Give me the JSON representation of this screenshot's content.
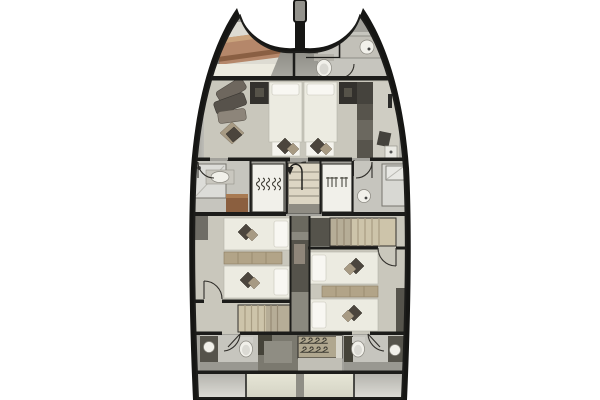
{
  "window": {
    "page-bg": "#ffffff"
  },
  "palette": {
    "hull": "#161614",
    "deck-side": "#a3a29c",
    "floor": "#c9c7bc",
    "floor-light": "#dddbd2",
    "floor-bath": "#c6c5be",
    "bed": "#ecebe1",
    "pillow-white": "#f8f7f2",
    "pillow-dark": "#4b453d",
    "pillow-tan": "#a79a83",
    "wood": "#b5876a",
    "wood-dark": "#8a5f43",
    "cabinet-dark": "#33312d",
    "cabinet-gray": "#57544c",
    "locker": "#f1f0ea",
    "stair": "#ddd6c4",
    "stair-aft": "#cdc4aa",
    "sideboard": "#b2a488",
    "fixture-white": "#f1f0ea",
    "counter-dark": "#55534b",
    "center-dark": "#8b897f",
    "wall": "#1c1c1a"
  },
  "plan": {
    "type": "catamaran-deck-plan",
    "orientation": "bow-up",
    "hulls": 2,
    "rooms": [
      {
        "name": "port-bow-cabin",
        "furniture": [
          "crew-berth"
        ]
      },
      {
        "name": "starboard-bow-head",
        "furniture": [
          "sink",
          "toilet",
          "door"
        ]
      },
      {
        "name": "owner-cabin-forward",
        "furniture": [
          "sofa",
          "armchair-cushions",
          "dresser-port",
          "berth-port",
          "berth-starboard",
          "dresser-starboard",
          "wardrobe",
          "stool",
          "foot-benches"
        ]
      },
      {
        "name": "port-mid-bathroom",
        "furniture": [
          "shower",
          "vanity-sink",
          "wood-counter",
          "door"
        ]
      },
      {
        "name": "forward-companionway",
        "furniture": [
          "staircase-with-arrow",
          "hanging-locker-port",
          "hanging-locker-starboard"
        ]
      },
      {
        "name": "starboard-mid-bathroom",
        "furniture": [
          "shower",
          "sink",
          "mirror",
          "door"
        ]
      },
      {
        "name": "port-aft-cabin",
        "furniture": [
          "twin-berth-forward",
          "sideboard",
          "twin-berth-aft",
          "door",
          "staircase"
        ]
      },
      {
        "name": "starboard-aft-cabin",
        "furniture": [
          "staircase",
          "twin-berth-forward",
          "sideboard",
          "twin-berth-aft",
          "door"
        ]
      },
      {
        "name": "port-aft-head",
        "furniture": [
          "toilet",
          "sink-counter",
          "door"
        ]
      },
      {
        "name": "aft-hanging-locker",
        "furniture": [
          "clothes-hangers"
        ]
      },
      {
        "name": "starboard-aft-head",
        "furniture": [
          "toilet",
          "sink-counter",
          "door"
        ]
      },
      {
        "name": "transom-platforms",
        "furniture": [
          "swim-steps-port",
          "swim-steps-starboard"
        ]
      }
    ],
    "icons": [
      "bed-icon",
      "pillow-icon",
      "toilet-icon",
      "sink-icon",
      "shower-icon",
      "clothes-hanger-icon",
      "staircase-icon",
      "door-swing-icon",
      "sofa-icon",
      "mast-fitting-icon"
    ]
  }
}
